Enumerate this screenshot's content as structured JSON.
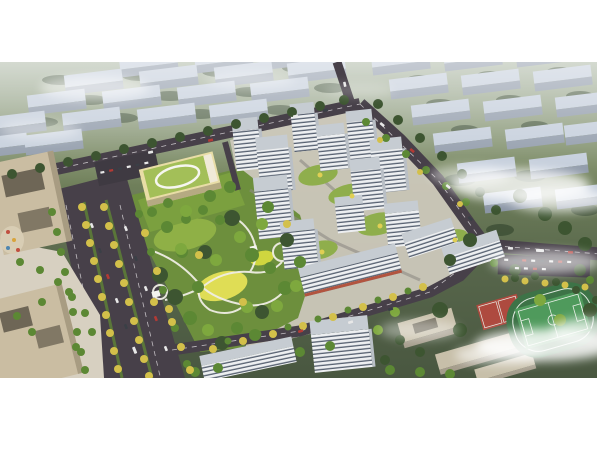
{
  "meta": {
    "type": "architectural-aerial-rendering",
    "description": "Bird's-eye 3D rendering of a residential development: white high-rise towers around green courtyards, a kindergarten with a green roof and white rooftop loop, a large landscaped central park with winding white paths and a yellow lawn, a wide tree-lined boulevard, tan office buildings at left, a school campus with red basketball courts and a green sports field at lower right, and hazy diagonal rows of city blocks with drifting mist in the background.",
    "canvas": {
      "width": 600,
      "height": 450
    },
    "photo_region": {
      "x": 0,
      "y": 62,
      "width": 597,
      "height": 316
    }
  },
  "scene": {
    "page_background": "#ffffff",
    "background": {
      "label": "hazy city blocks",
      "building_color": "#c1cbd9",
      "building_side_color": "#8b96a6",
      "terrain_top": "#a9b5a2",
      "terrain_bottom": "#495740",
      "hedge_color": "#3a4c33"
    },
    "clouds": {
      "label": "mist clouds",
      "color": "#ffffff"
    },
    "roads": {
      "label": "asphalt roads",
      "color": "#474049",
      "marking_color": "#d8d4d8",
      "inner_path_color": "#8d8a84"
    },
    "parking": {
      "label": "parking lots",
      "color": "#3f3a42"
    },
    "park": {
      "label": "central landscaped park",
      "base": "#6d8f3d",
      "meadow": "#8fb046",
      "lawn": "#dfdd55",
      "path": "#efede4",
      "pavilion": "#f4f4ee"
    },
    "towers": {
      "label": "white residential towers",
      "face": "#edeff1",
      "window": "#566070",
      "roof": "#c6ccd2",
      "side": "#b9bfc6",
      "podium_garden": "#8fae4c",
      "awning": "#b2543f"
    },
    "kindergarten": {
      "label": "kindergarten with rooftop loop",
      "roof": "#a3bf58",
      "body": "#e8dda6",
      "loop": "#f6f6f0"
    },
    "offices": {
      "label": "tan office buildings",
      "body": "#cabda2",
      "courtyard": "#6e6656",
      "plaza": "#d7d0c1",
      "grid_line": "#b0a489"
    },
    "school": {
      "label": "school campus",
      "roof": "#c7bfa9",
      "face": "#a59d8c"
    },
    "sports": {
      "label": "sports grounds",
      "pitch": "#4f9a5c",
      "track": "#3d7347",
      "court": "#ae4a3f",
      "lines": "#e9efe7"
    },
    "trees": {
      "dark": "#3d5531",
      "green": "#5c8834",
      "light": "#7ea83e",
      "yellow": "#d3c04a",
      "fleck": "#e0cf54"
    },
    "vehicles": {
      "white": "#e8e8e8",
      "red": "#b33a35",
      "dark": "#3a3f46"
    }
  }
}
